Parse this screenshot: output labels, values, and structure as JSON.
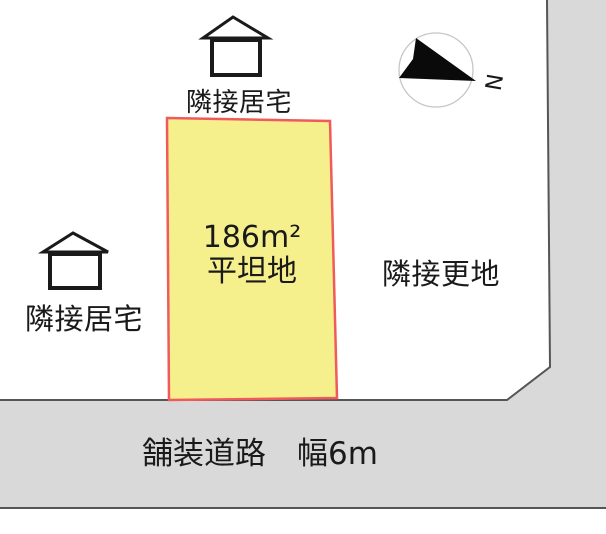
{
  "colors": {
    "plot_fill": "#F6F08C",
    "plot_border": "#F15A5C",
    "road_fill": "#D9D9D9",
    "road_border": "#555555",
    "compass_ring": "#C6C6C6",
    "text": "#1A1A1A"
  },
  "plot": {
    "area": "186m²",
    "terrain": "平坦地"
  },
  "neighbors": {
    "top_house": "隣接居宅",
    "left_house": "隣接居宅",
    "right_vacant": "隣接更地"
  },
  "road": {
    "label": "舗装道路　幅6m"
  },
  "compass": {
    "north": "N"
  }
}
